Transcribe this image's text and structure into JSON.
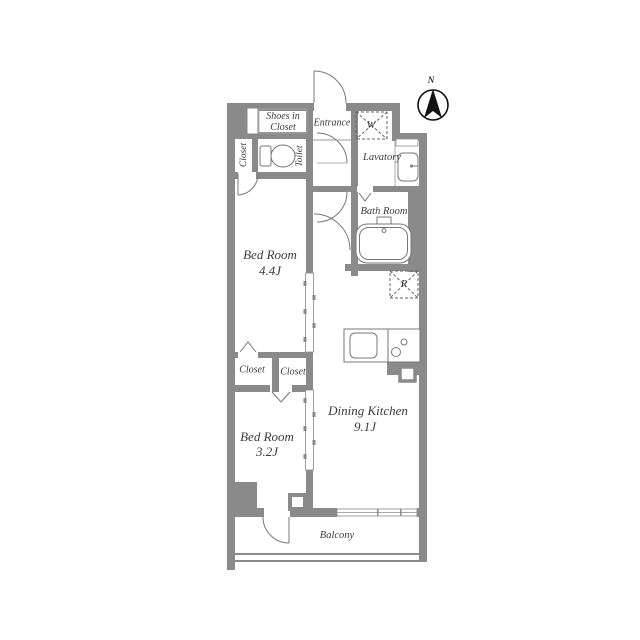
{
  "plan_title": "1DK apartment floor plan",
  "compass": {
    "north_label": "N"
  },
  "rooms": {
    "shoes_closet": {
      "line1": "Shoes in",
      "line2": "Closet"
    },
    "entrance": {
      "label": "Entrance"
    },
    "washer": {
      "label": "W"
    },
    "lavatory": {
      "label": "Lavatory"
    },
    "closet_upper": {
      "label": "Closet"
    },
    "toilet": {
      "label": "Toilet"
    },
    "bath": {
      "label": "Bath Room"
    },
    "bedroom1": {
      "name": "Bed Room",
      "size": "4.4J"
    },
    "fridge": {
      "label": "R"
    },
    "closet_left": {
      "label": "Closet"
    },
    "closet_right": {
      "label": "Closet"
    },
    "dining_kitchen": {
      "name": "Dining Kitchen",
      "size": "9.1J"
    },
    "bedroom2": {
      "name": "Bed Room",
      "size": "3.2J"
    },
    "balcony": {
      "label": "Balcony"
    }
  },
  "colors": {
    "wall": "#8a8a8a",
    "fixture_line": "#777777",
    "thin_line": "#999999",
    "text": "#3b3b3b",
    "background": "#ffffff",
    "compass": "#111111"
  }
}
